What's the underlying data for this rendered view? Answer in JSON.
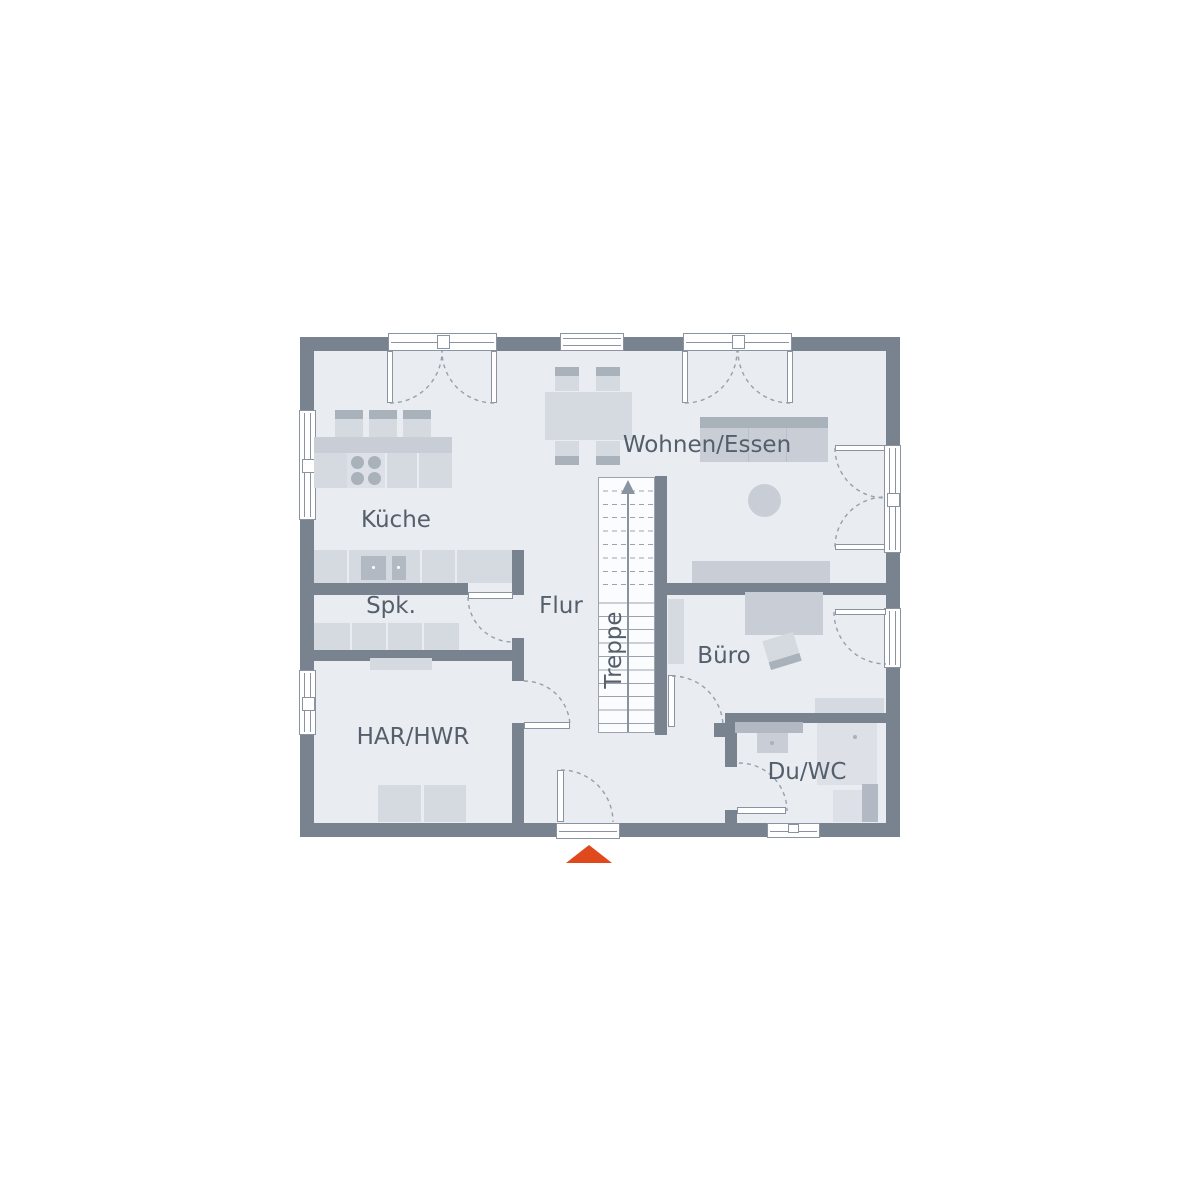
{
  "plan": {
    "rooms": {
      "kueche": {
        "label": "Küche"
      },
      "spk": {
        "label": "Spk."
      },
      "har_hwr": {
        "label": "HAR/HWR"
      },
      "flur": {
        "label": "Flur"
      },
      "treppe": {
        "label": "Treppe"
      },
      "wohnen_essen": {
        "label": "Wohnen/Essen"
      },
      "buero": {
        "label": "Büro"
      },
      "du_wc": {
        "label": "Du/WC"
      }
    },
    "colors": {
      "wall": "#79838F",
      "floor": "#E9ECF1",
      "line": "#8A94A0",
      "label_text": "#545F6B",
      "furniture_light": "#D5D9E0",
      "furniture_medium": "#C9CED6",
      "furniture_dark": "#A9B1BB",
      "fixture": "#B2B9C3",
      "fixture_light": "#DDE0E6",
      "entrance_marker": "#E0481E"
    },
    "icons": {
      "entrance_marker": "triangle-up",
      "stairs_direction": "arrow-up"
    }
  }
}
